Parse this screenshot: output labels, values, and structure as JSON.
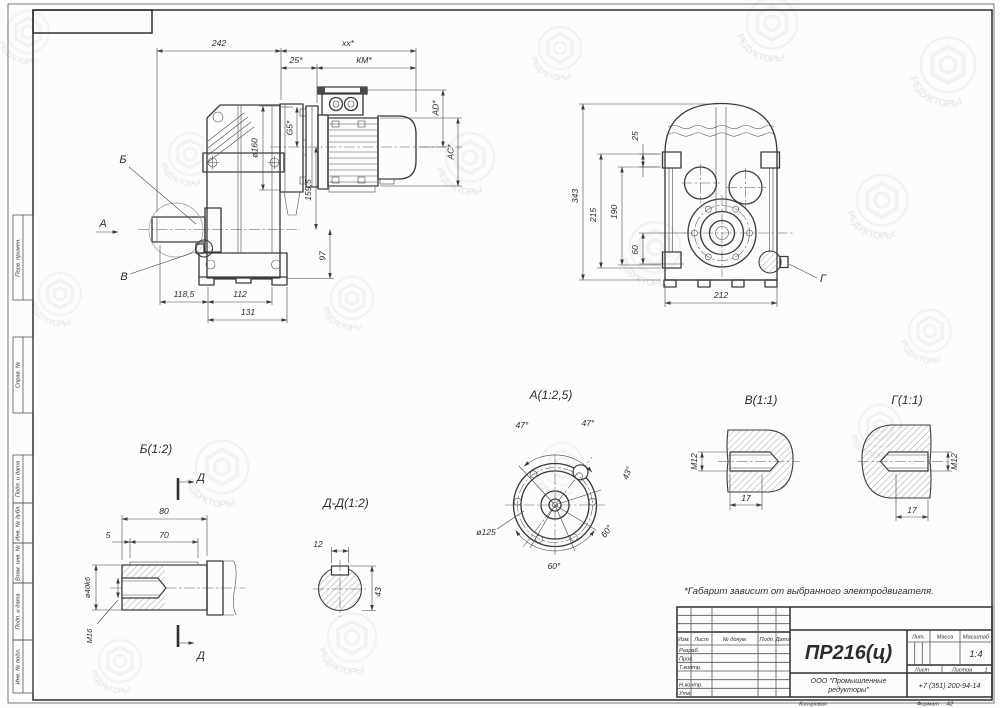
{
  "note": "*Габарит зависит от выбранного электродвигателя.",
  "watermark_text": "РЕДУКТОРЫ",
  "margin_labels": [
    "Перв. примен.",
    "Справ. №",
    "Подп. и дата",
    "Инв. № дубл.",
    "Взам. инв. №",
    "Подп. и дата",
    "Инв. № подл."
  ],
  "views": {
    "side": {
      "labels": {
        "b": "Б",
        "a": "А",
        "v": "В"
      },
      "dims": {
        "total": "242",
        "xx": "xx*",
        "z25": "25*",
        "km": "КМ*",
        "ad": "AD*",
        "ac": "AC*",
        "g5": "G5*",
        "d160": "ø160",
        "h1595": "159,5",
        "h97": "97",
        "b1185": "118,5",
        "b112": "112",
        "b131": "131"
      }
    },
    "front": {
      "label_g": "Г",
      "dims": {
        "h343": "343",
        "h215": "215",
        "h190": "190",
        "t25": "25",
        "h60": "60",
        "w212": "212"
      }
    },
    "detail_b": {
      "title": "Б(1:2)",
      "marker": "Д",
      "dims": {
        "l80": "80",
        "l5": "5",
        "l70": "70",
        "dia": "ø40k6",
        "thread": "М16"
      }
    },
    "section_dd": {
      "title": "Д-Д(1:2)",
      "dims": {
        "w12": "12",
        "h43": "43"
      }
    },
    "detail_a": {
      "title": "А(1:2,5)",
      "dims": {
        "a47l": "47°",
        "a47r": "47°",
        "a43": "43°",
        "a60r": "60°",
        "a60b": "60°",
        "dia": "ø125"
      }
    },
    "detail_v": {
      "title": "В(1:1)",
      "dims": {
        "thread": "М12",
        "depth": "17"
      }
    },
    "detail_g": {
      "title": "Г(1:1)",
      "dims": {
        "thread": "М12",
        "depth": "17"
      }
    }
  },
  "title_block": {
    "doc_number": "ПР216(ц)",
    "company_line1": "ООО \"Промышленные",
    "company_line2": "редукторы\"",
    "phone": "+7 (351) 200-94-14",
    "headers": {
      "izm": "Изм.",
      "list": "Лист",
      "doc": "№ докум.",
      "podp": "Подп.",
      "date": "Дата"
    },
    "rows": {
      "razrab": "Разраб.",
      "prov": "Пров.",
      "tkontr": "Т.контр.",
      "nkontr": "Н.контр.",
      "utv": "Утв."
    },
    "lit_label": "Лит.",
    "mass_label": "Масса",
    "scale_label": "Масштаб",
    "scale_value": "1:4",
    "sheet_label": "Лист",
    "sheets_label": "Листов",
    "sheets_value": "1",
    "copied": "Копировал",
    "format_label": "Формат",
    "format_value": "А2"
  }
}
